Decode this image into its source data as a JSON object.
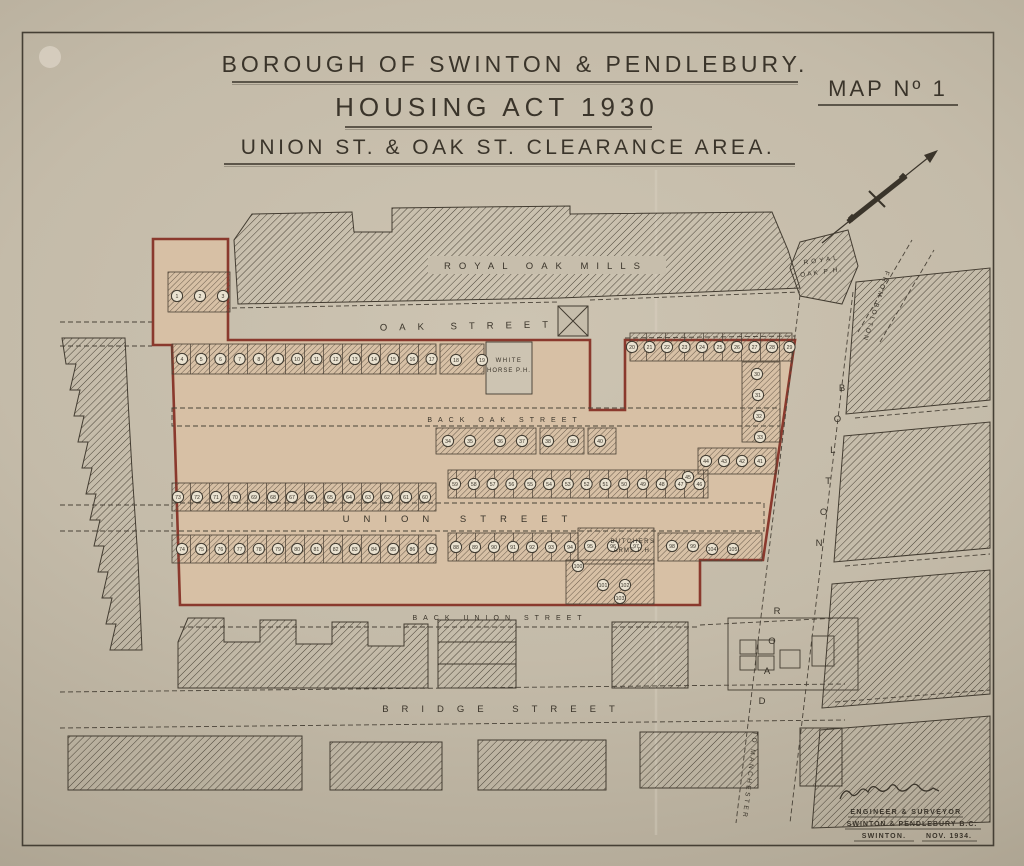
{
  "title": {
    "line1": "BOROUGH OF SWINTON & PENDLEBURY.",
    "line2": "HOUSING ACT 1930",
    "line3": "UNION ST. & OAK ST. CLEARANCE AREA.",
    "map_no": "MAP Nº 1"
  },
  "colors": {
    "paper": "#c7beac",
    "ink": "#3a342a",
    "clearance_fill": "#d7c0a5",
    "boundary_red": "#8a392d"
  },
  "map": {
    "streets": {
      "oak": "OAK STREET",
      "back_oak": "BACK OAK STREET",
      "union": "UNION STREET",
      "back_union": "BACK UNION STREET",
      "bridge": "BRIDGE STREET",
      "bolton_road": "BOLTON ROAD"
    },
    "places": {
      "royal_oak_mills": "ROYAL OAK MILLS",
      "royal_oak_ph": [
        "ROYAL",
        "OAK P.H."
      ],
      "white_horse_ph": [
        "WHITE",
        "HORSE P.H."
      ],
      "butchers_arms_ph": [
        "BUTCHERS",
        "ARMS P.H."
      ]
    },
    "routes": {
      "from_bolton": "FROM BOLTON",
      "to_manchester": "TO MANCHESTER"
    },
    "house_rows": [
      {
        "from": 1,
        "to": 3,
        "x": 177,
        "y": 296,
        "dx": 23
      },
      {
        "from": 4,
        "to": 17,
        "x": 182,
        "y": 359,
        "dx": 19.2
      },
      {
        "from": 18,
        "to": 19,
        "x": 456,
        "y": 360,
        "dx": 26
      },
      {
        "from": 20,
        "to": 29,
        "x": 632,
        "y": 347,
        "dx": 17.5
      },
      {
        "from": 30,
        "to": 33,
        "x": 757,
        "y": 374,
        "dx": 1,
        "dy": 21
      },
      {
        "from": 34,
        "to": 35,
        "x": 448,
        "y": 441,
        "dx": 22
      },
      {
        "from": 36,
        "to": 37,
        "x": 500,
        "y": 441,
        "dx": 22
      },
      {
        "from": 38,
        "to": 39,
        "x": 548,
        "y": 441,
        "dx": 25
      },
      {
        "from": 40,
        "to": 40,
        "x": 600,
        "y": 441
      },
      {
        "from": 44,
        "to": 41,
        "x": 706,
        "y": 461,
        "dx": 18
      },
      {
        "from": 45,
        "to": 45,
        "x": 688,
        "y": 477
      },
      {
        "from": 59,
        "to": 46,
        "x": 455,
        "y": 484,
        "dx": 18.8
      },
      {
        "from": 73,
        "to": 60,
        "x": 178,
        "y": 497,
        "dx": 19
      },
      {
        "from": 74,
        "to": 87,
        "x": 182,
        "y": 549,
        "dx": 19.2
      },
      {
        "from": 88,
        "to": 94,
        "x": 456,
        "y": 547,
        "dx": 19
      },
      {
        "from": 95,
        "to": 97,
        "x": 590,
        "y": 546,
        "dx": 23
      },
      {
        "from": 98,
        "to": 99,
        "x": 672,
        "y": 546,
        "dx": 21
      },
      {
        "from": 100,
        "to": 100,
        "x": 578,
        "y": 566
      },
      {
        "from": 101,
        "to": 102,
        "x": 603,
        "y": 585,
        "dx": 22
      },
      {
        "from": 103,
        "to": 103,
        "x": 620,
        "y": 598
      },
      {
        "from": 104,
        "to": 105,
        "x": 712,
        "y": 549,
        "dx": 21
      }
    ]
  },
  "signature": {
    "line1": "ENGINEER & SURVEYOR",
    "line2": "SWINTON & PENDLEBURY B.C.",
    "place": "SWINTON.",
    "date": "NOV. 1934."
  }
}
